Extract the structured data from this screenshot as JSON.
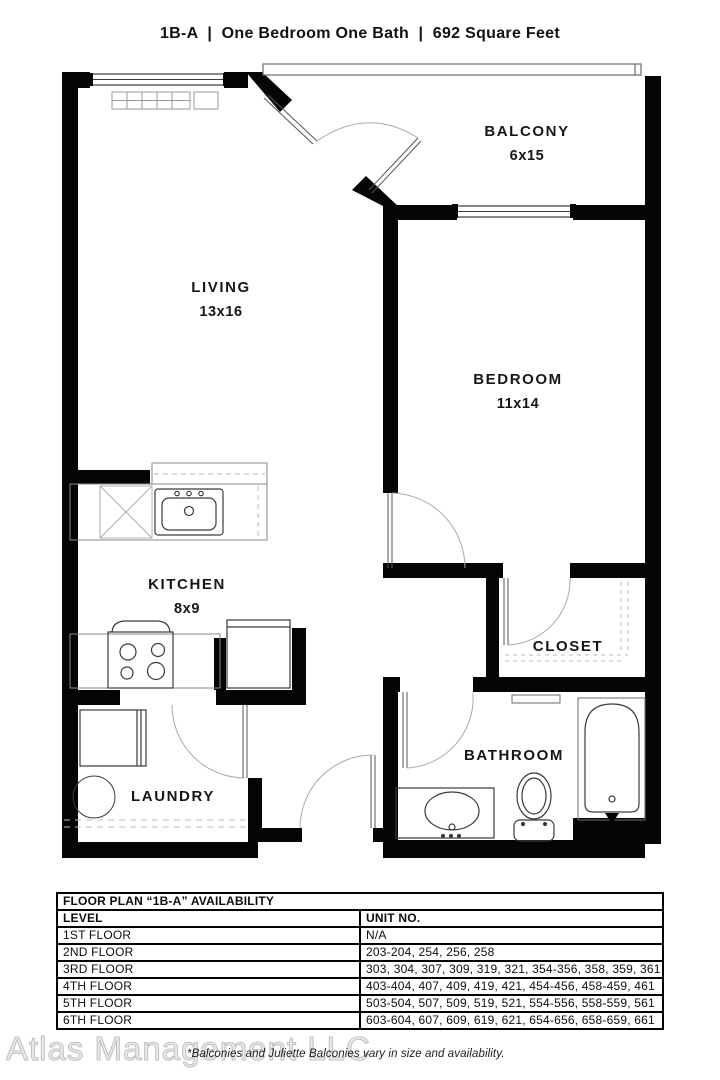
{
  "title": "1B-A  |  One Bedroom One Bath  |  692 Square Feet",
  "plan": {
    "rooms": {
      "balcony": {
        "name": "BALCONY",
        "dims": "6x15"
      },
      "living": {
        "name": "LIVING",
        "dims": "13x16"
      },
      "bedroom": {
        "name": "BEDROOM",
        "dims": "11x14"
      },
      "kitchen": {
        "name": "KITCHEN",
        "dims": "8x9"
      },
      "closet": {
        "name": "CLOSET"
      },
      "bathroom": {
        "name": "BATHROOM"
      },
      "laundry": {
        "name": "LAUNDRY"
      }
    }
  },
  "availability": {
    "title": "FLOOR PLAN “1B-A” AVAILABILITY",
    "columns": {
      "level": "LEVEL",
      "units": "UNIT NO."
    },
    "rows": [
      {
        "level": "1ST FLOOR",
        "units": "N/A"
      },
      {
        "level": "2ND FLOOR",
        "units": "203-204, 254, 256, 258"
      },
      {
        "level": "3RD FLOOR",
        "units": "303, 304, 307, 309, 319, 321, 354-356, 358, 359, 361"
      },
      {
        "level": "4TH FLOOR",
        "units": "403-404, 407, 409, 419, 421, 454-456, 458-459, 461"
      },
      {
        "level": "5TH FLOOR",
        "units": "503-504, 507, 509, 519, 521, 554-556, 558-559, 561"
      },
      {
        "level": "6TH FLOOR",
        "units": "603-604, 607, 609, 619, 621, 654-656, 658-659, 661"
      }
    ]
  },
  "footer": {
    "watermark": "Atlas Management LLC",
    "note": "*Balconies and Juliette Balconies vary in size and availability."
  },
  "colors": {
    "wall": "#050505",
    "fixture": "#3a3a3a",
    "light": "#b5b5b5",
    "watermark": "#c2c2c2"
  }
}
